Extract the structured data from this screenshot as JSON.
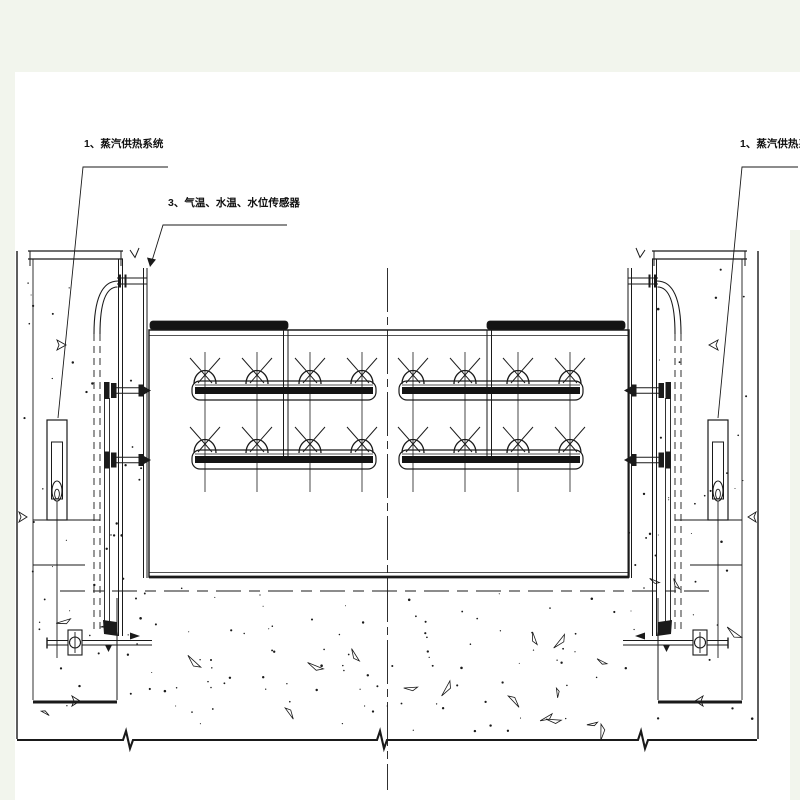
{
  "page": {
    "paper_color": "#ffffff",
    "margin_color": "#f2f5ed",
    "line_color": "#1a1a1a"
  },
  "labels": {
    "steam_left": "1、蒸汽供热系统",
    "sensors": "3、气温、水温、水位传感器",
    "steam_right": "1、蒸汽供热系统"
  },
  "structure": {
    "drawing_type": "gate-section-with-steam-heating",
    "nozzle_rows": 2,
    "pipe_assemblies": 4,
    "nozzles_per_pipe": 4,
    "total_nozzles": 16,
    "piers": 2,
    "level_sensors": 2,
    "valves": 2
  }
}
